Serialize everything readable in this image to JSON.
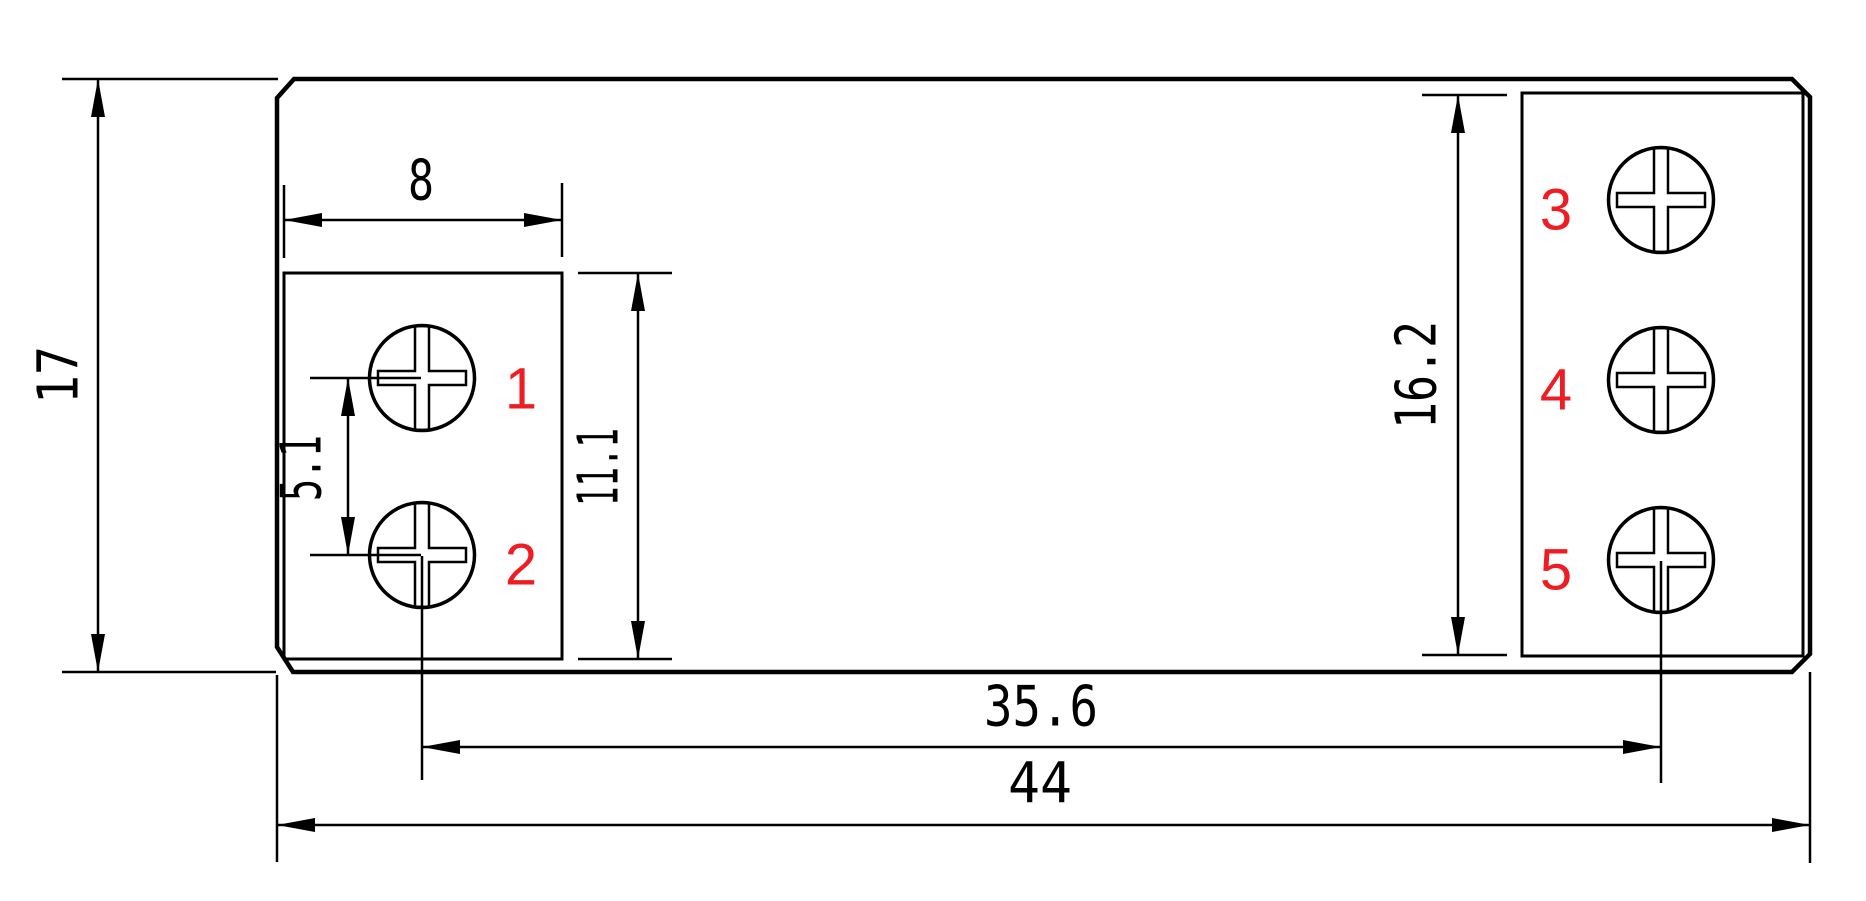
{
  "drawing": {
    "title": "terminal-block-dimension-drawing",
    "canvas": {
      "width": 1866,
      "height": 901,
      "background": "#ffffff",
      "line_color": "#000000",
      "label_color": "#ee1c23"
    },
    "body": {
      "path": "M 294 79 L 1792 79 L 1810 97 L 1810 654 L 1792 672 L 293 672 L 277 647 L 277 98 Z",
      "stroke_width": 4.5
    },
    "blocks": [
      {
        "name": "left-terminal-block",
        "x": 284,
        "y": 273,
        "w": 278,
        "h": 386,
        "stroke_width": 3
      },
      {
        "name": "right-terminal-block",
        "x": 1522,
        "y": 93,
        "w": 281,
        "h": 563,
        "stroke_width": 3
      }
    ],
    "screw_style": {
      "radius": 52.5,
      "circle_stroke": 3.5,
      "cross_stroke": 2.5,
      "cross_half_width": 7,
      "cross_arm": 44
    },
    "screws": [
      {
        "label": "1",
        "cx": 422,
        "cy": 378,
        "label_x": 521,
        "label_y": 389
      },
      {
        "label": "2",
        "cx": 422,
        "cy": 555,
        "label_x": 521,
        "label_y": 565
      },
      {
        "label": "3",
        "cx": 1661,
        "cy": 200,
        "label_x": 1556,
        "label_y": 210
      },
      {
        "label": "4",
        "cx": 1661,
        "cy": 380,
        "label_x": 1556,
        "label_y": 390
      },
      {
        "label": "5",
        "cx": 1661,
        "cy": 560,
        "label_x": 1556,
        "label_y": 570
      }
    ],
    "centerlines": [
      {
        "x1": 422,
        "y1": 556,
        "x2": 422,
        "y2": 780
      },
      {
        "x1": 1661,
        "y1": 561,
        "x2": 1661,
        "y2": 783
      }
    ],
    "arrow_style": {
      "length": 38,
      "half_width": 7
    },
    "dimensions": [
      {
        "value": "17",
        "text": {
          "x": 59,
          "y": 375,
          "rotate": true,
          "length": 58
        },
        "line": {
          "x1": 98,
          "y1": 79,
          "x2": 98,
          "y2": 672
        },
        "arrows": [
          {
            "x": 98,
            "y": 79,
            "dir": "up"
          },
          {
            "x": 98,
            "y": 672,
            "dir": "down"
          }
        ],
        "ext": [
          {
            "x1": 62,
            "y1": 79,
            "x2": 278,
            "y2": 79
          },
          {
            "x1": 62,
            "y1": 672,
            "x2": 276,
            "y2": 672
          }
        ]
      },
      {
        "value": "8",
        "text": {
          "x": 421,
          "y": 181,
          "rotate": false,
          "length": 26
        },
        "line": {
          "x1": 284,
          "y1": 220,
          "x2": 562,
          "y2": 220
        },
        "arrows": [
          {
            "x": 284,
            "y": 220,
            "dir": "left"
          },
          {
            "x": 562,
            "y": 220,
            "dir": "right"
          }
        ],
        "ext": [
          {
            "x1": 284,
            "y1": 185,
            "x2": 284,
            "y2": 258
          },
          {
            "x1": 562,
            "y1": 183,
            "x2": 562,
            "y2": 257
          }
        ]
      },
      {
        "value": "5.1",
        "text": {
          "x": 302,
          "y": 468,
          "rotate": true,
          "length": 66
        },
        "line": {
          "x1": 348,
          "y1": 378,
          "x2": 348,
          "y2": 555
        },
        "arrows": [
          {
            "x": 348,
            "y": 378,
            "dir": "up"
          },
          {
            "x": 348,
            "y": 555,
            "dir": "down"
          }
        ],
        "ext": [
          {
            "x1": 310,
            "y1": 378,
            "x2": 421,
            "y2": 378
          },
          {
            "x1": 310,
            "y1": 555,
            "x2": 421,
            "y2": 555
          }
        ]
      },
      {
        "value": "11.1",
        "text": {
          "x": 599,
          "y": 467,
          "rotate": true,
          "length": 78
        },
        "line": {
          "x1": 638,
          "y1": 273,
          "x2": 638,
          "y2": 659
        },
        "arrows": [
          {
            "x": 638,
            "y": 273,
            "dir": "up"
          },
          {
            "x": 638,
            "y": 659,
            "dir": "down"
          }
        ],
        "ext": [
          {
            "x1": 578,
            "y1": 273,
            "x2": 672,
            "y2": 273
          },
          {
            "x1": 578,
            "y1": 659,
            "x2": 672,
            "y2": 659
          }
        ]
      },
      {
        "value": "16.2",
        "text": {
          "x": 1417,
          "y": 375,
          "rotate": true,
          "length": 108
        },
        "line": {
          "x1": 1458,
          "y1": 95,
          "x2": 1458,
          "y2": 655
        },
        "arrows": [
          {
            "x": 1458,
            "y": 95,
            "dir": "up"
          },
          {
            "x": 1458,
            "y": 655,
            "dir": "down"
          }
        ],
        "ext": [
          {
            "x1": 1422,
            "y1": 95,
            "x2": 1507,
            "y2": 95
          },
          {
            "x1": 1422,
            "y1": 655,
            "x2": 1507,
            "y2": 655
          }
        ]
      },
      {
        "value": "35.6",
        "text": {
          "x": 1041,
          "y": 707,
          "rotate": false,
          "length": 114
        },
        "line": {
          "x1": 422,
          "y1": 747,
          "x2": 1661,
          "y2": 747
        },
        "arrows": [
          {
            "x": 422,
            "y": 747,
            "dir": "left"
          },
          {
            "x": 1661,
            "y": 747,
            "dir": "right"
          }
        ],
        "ext": []
      },
      {
        "value": "44",
        "text": {
          "x": 1040,
          "y": 784,
          "rotate": false,
          "length": 64
        },
        "line": {
          "x1": 277,
          "y1": 825,
          "x2": 1810,
          "y2": 825
        },
        "arrows": [
          {
            "x": 277,
            "y": 825,
            "dir": "left"
          },
          {
            "x": 1810,
            "y": 825,
            "dir": "right"
          }
        ],
        "ext": [
          {
            "x1": 277,
            "y1": 675,
            "x2": 277,
            "y2": 862
          },
          {
            "x1": 1810,
            "y1": 672,
            "x2": 1810,
            "y2": 863
          }
        ]
      }
    ]
  }
}
